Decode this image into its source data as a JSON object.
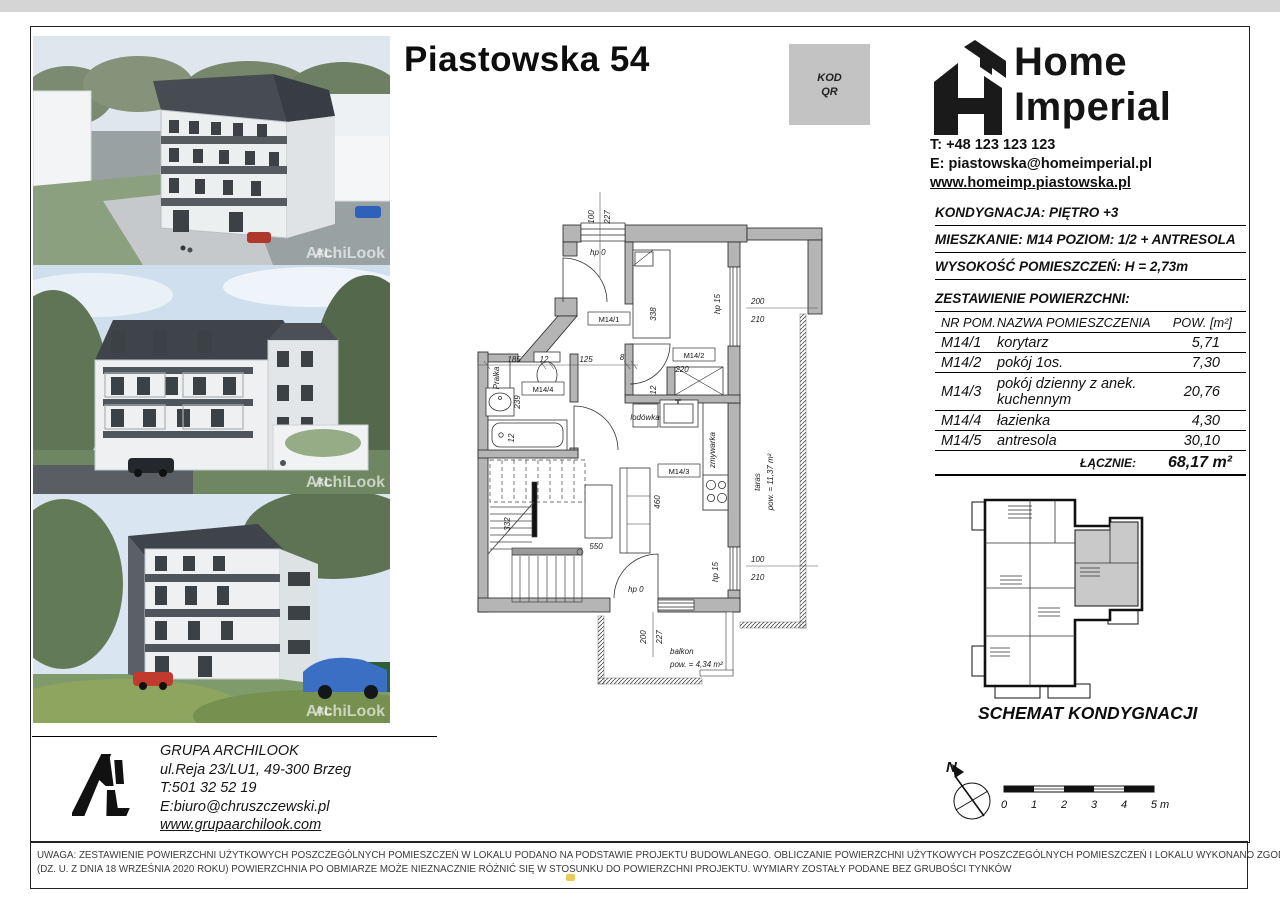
{
  "page": {
    "title": "Piastowska 54",
    "qr": {
      "line1": "KOD",
      "line2": "QR"
    }
  },
  "developer": {
    "name_line1": "Home",
    "name_line2": "Imperial",
    "phone": "T: +48 123 123 123",
    "email": "E: piastowska@homeimperial.pl",
    "website": "www.homeimp.piastowska.pl"
  },
  "unit_info": {
    "floor": "KONDYGNACJA: PIĘTRO +3",
    "apartment": "MIESZKANIE: M14 POZIOM: 1/2 + ANTRESOLA",
    "height": "WYSOKOŚĆ POMIESZCZEŃ: H = 2,73m",
    "areas_title": "ZESTAWIENIE POWIERZCHNI:",
    "table": {
      "headers": [
        "NR POM.",
        "NAZWA POMIESZCZENIA",
        "POW. [m²]"
      ],
      "rows": [
        {
          "no": "M14/1",
          "name": "korytarz",
          "area": "5,71"
        },
        {
          "no": "M14/2",
          "name": "pokój 1os.",
          "area": "7,30"
        },
        {
          "no": "M14/3",
          "name": "pokój dzienny z anek. kuchennym",
          "area": "20,76"
        },
        {
          "no": "M14/4",
          "name": "łazienka",
          "area": "4,30"
        },
        {
          "no": "M14/5",
          "name": "antresola",
          "area": "30,10"
        }
      ],
      "total_label": "ŁĄCZNIE:",
      "total_value": "68,17 m²"
    }
  },
  "floor_plan": {
    "dims": {
      "top_a": "100",
      "top_b": "227",
      "right_top_a": "200",
      "right_top_b": "210",
      "mid_a": "185",
      "mid_b": "12",
      "mid_c": "125",
      "mid_d": "8",
      "room2_width": "220",
      "bed": "338",
      "wardrobe": "12",
      "sink": "239",
      "tub": "12",
      "stairs": "332",
      "living_v": "460",
      "living_h": "550",
      "right_bottom_a": "100",
      "right_bottom_b": "210",
      "balcony_a": "200",
      "balcony_b": "227"
    },
    "labels": {
      "door_top": "hp 0",
      "door_bottom": "hp 0",
      "window_right": "hp 15",
      "window_bottom_right": "hp 15",
      "room1": "M14/1",
      "room2": "M14/2",
      "room3": "M14/3",
      "room4": "M14/4",
      "washer": "Pralka",
      "fridge": "lodówka",
      "dishwasher": "zmywarka",
      "terrace_1": "taras",
      "terrace_2": "pow. = 11,37 m²",
      "balcony_1": "balkon",
      "balcony_2": "pow. = 4,34 m²"
    }
  },
  "schematic": {
    "caption": "SCHEMAT KONDYGNACJI"
  },
  "compass": {
    "north": "N"
  },
  "scale_bar": {
    "ticks": [
      "0",
      "1",
      "2",
      "3",
      "4",
      "5 m"
    ]
  },
  "architect": {
    "name": "GRUPA ARCHILOOK",
    "address": "ul.Reja 23/LU1, 49-300 Brzeg",
    "phone": "T:501 32 52 19",
    "email": "E:biuro@chruszczewski.pl",
    "website": "www.grupaarchilook.com"
  },
  "watermark": {
    "logo": "AL",
    "name": "ArchiLook"
  },
  "disclaimer": {
    "line1": "UWAGA: ZESTAWIENIE POWIERZCHNI UŻYTKOWYCH POSZCZEGÓLNYCH POMIESZCZEŃ W LOKALU PODANO NA PODSTAWIE PROJEKTU BUDOWLANEGO. OBLICZANIE POWIERZCHNI UŻYTKOWYCH POSZCZEGÓLNYCH POMIESZCZEŃ I LOKALU WYKONANO ZGODNIE Z ROZPORZĄDZENIEM MINISTRA ROZWOJU Z DN. 11.09.2020 r",
    "line2": "(DZ. U. Z DNIA 18 WRZEŚNIA 2020 ROKU) POWIERZCHNIA PO OBMIARZE MOŻE NIEZNACZNIE RÓŻNIĆ SIĘ W STOSUNKU DO POWIERZCHNI PROJEKTU. WYMIARY ZOSTAŁY PODANE BEZ GRUBOŚCI TYNKÓW"
  }
}
